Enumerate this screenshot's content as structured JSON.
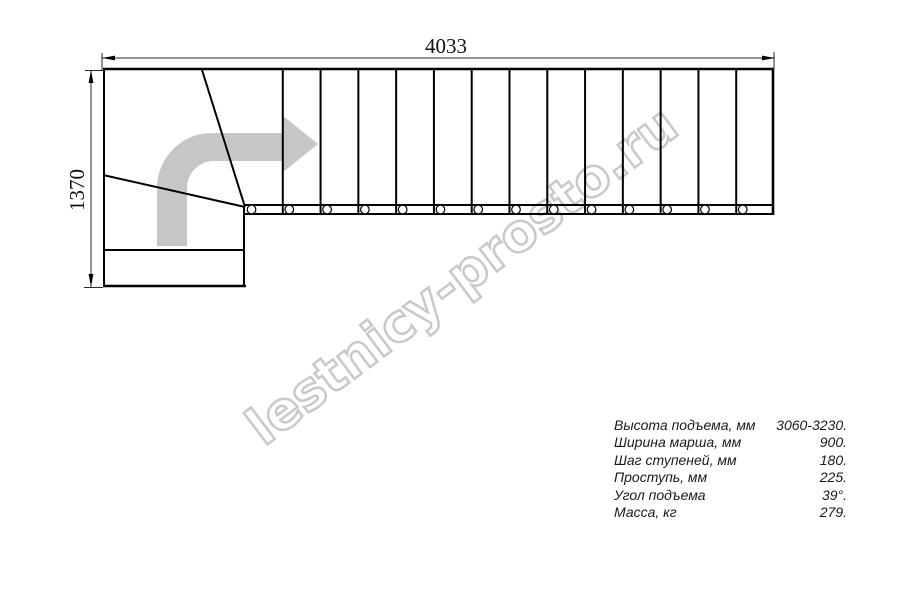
{
  "drawing": {
    "type": "staircase-plan-top-view",
    "dim_width_label": "4033",
    "dim_height_label": "1370",
    "watermark": "lestnicy-prosto.ru",
    "straight_flight_treads": 14,
    "winder_treads": 3,
    "colors": {
      "line": "#000000",
      "dim_line": "#2a2a2a",
      "direction_arrow": "#c6c6c6",
      "watermark": "#c9c9c9"
    }
  },
  "specs": {
    "rows": [
      {
        "label": "Высота подъема, мм",
        "value": "3060-3230."
      },
      {
        "label": "Ширина марша, мм",
        "value": "900."
      },
      {
        "label": "Шаг ступеней, мм",
        "value": "180."
      },
      {
        "label": "Проступь, мм",
        "value": "225."
      },
      {
        "label": "Угол подъема",
        "value": "39°."
      },
      {
        "label": "Масса, кг",
        "value": "279."
      }
    ]
  }
}
